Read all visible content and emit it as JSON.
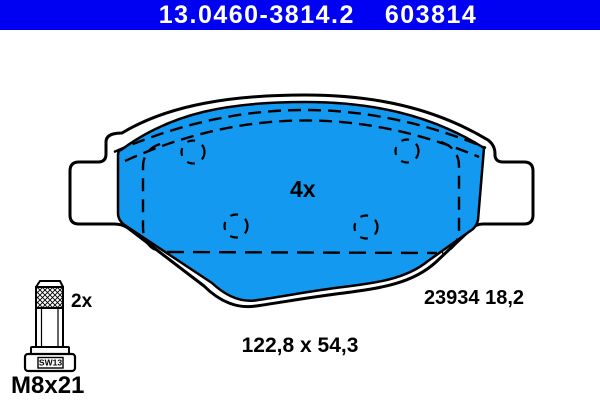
{
  "header": {
    "part_number": "13.0460-3814.2",
    "article_number": "603814"
  },
  "drawing": {
    "quantity_label": "4x",
    "reference_label": "23934 18,2",
    "dimensions_label": "122,8 x 54,3"
  },
  "accessory": {
    "quantity_label": "2x",
    "bolt_size_label": "M8x21",
    "wrench_size_label": "SW13"
  },
  "colors": {
    "header_bg": "#0000F2",
    "header_text": "#FFFFFF",
    "pad_fill": "#1499F0",
    "outline": "#000000",
    "background": "#FFFFFF"
  }
}
